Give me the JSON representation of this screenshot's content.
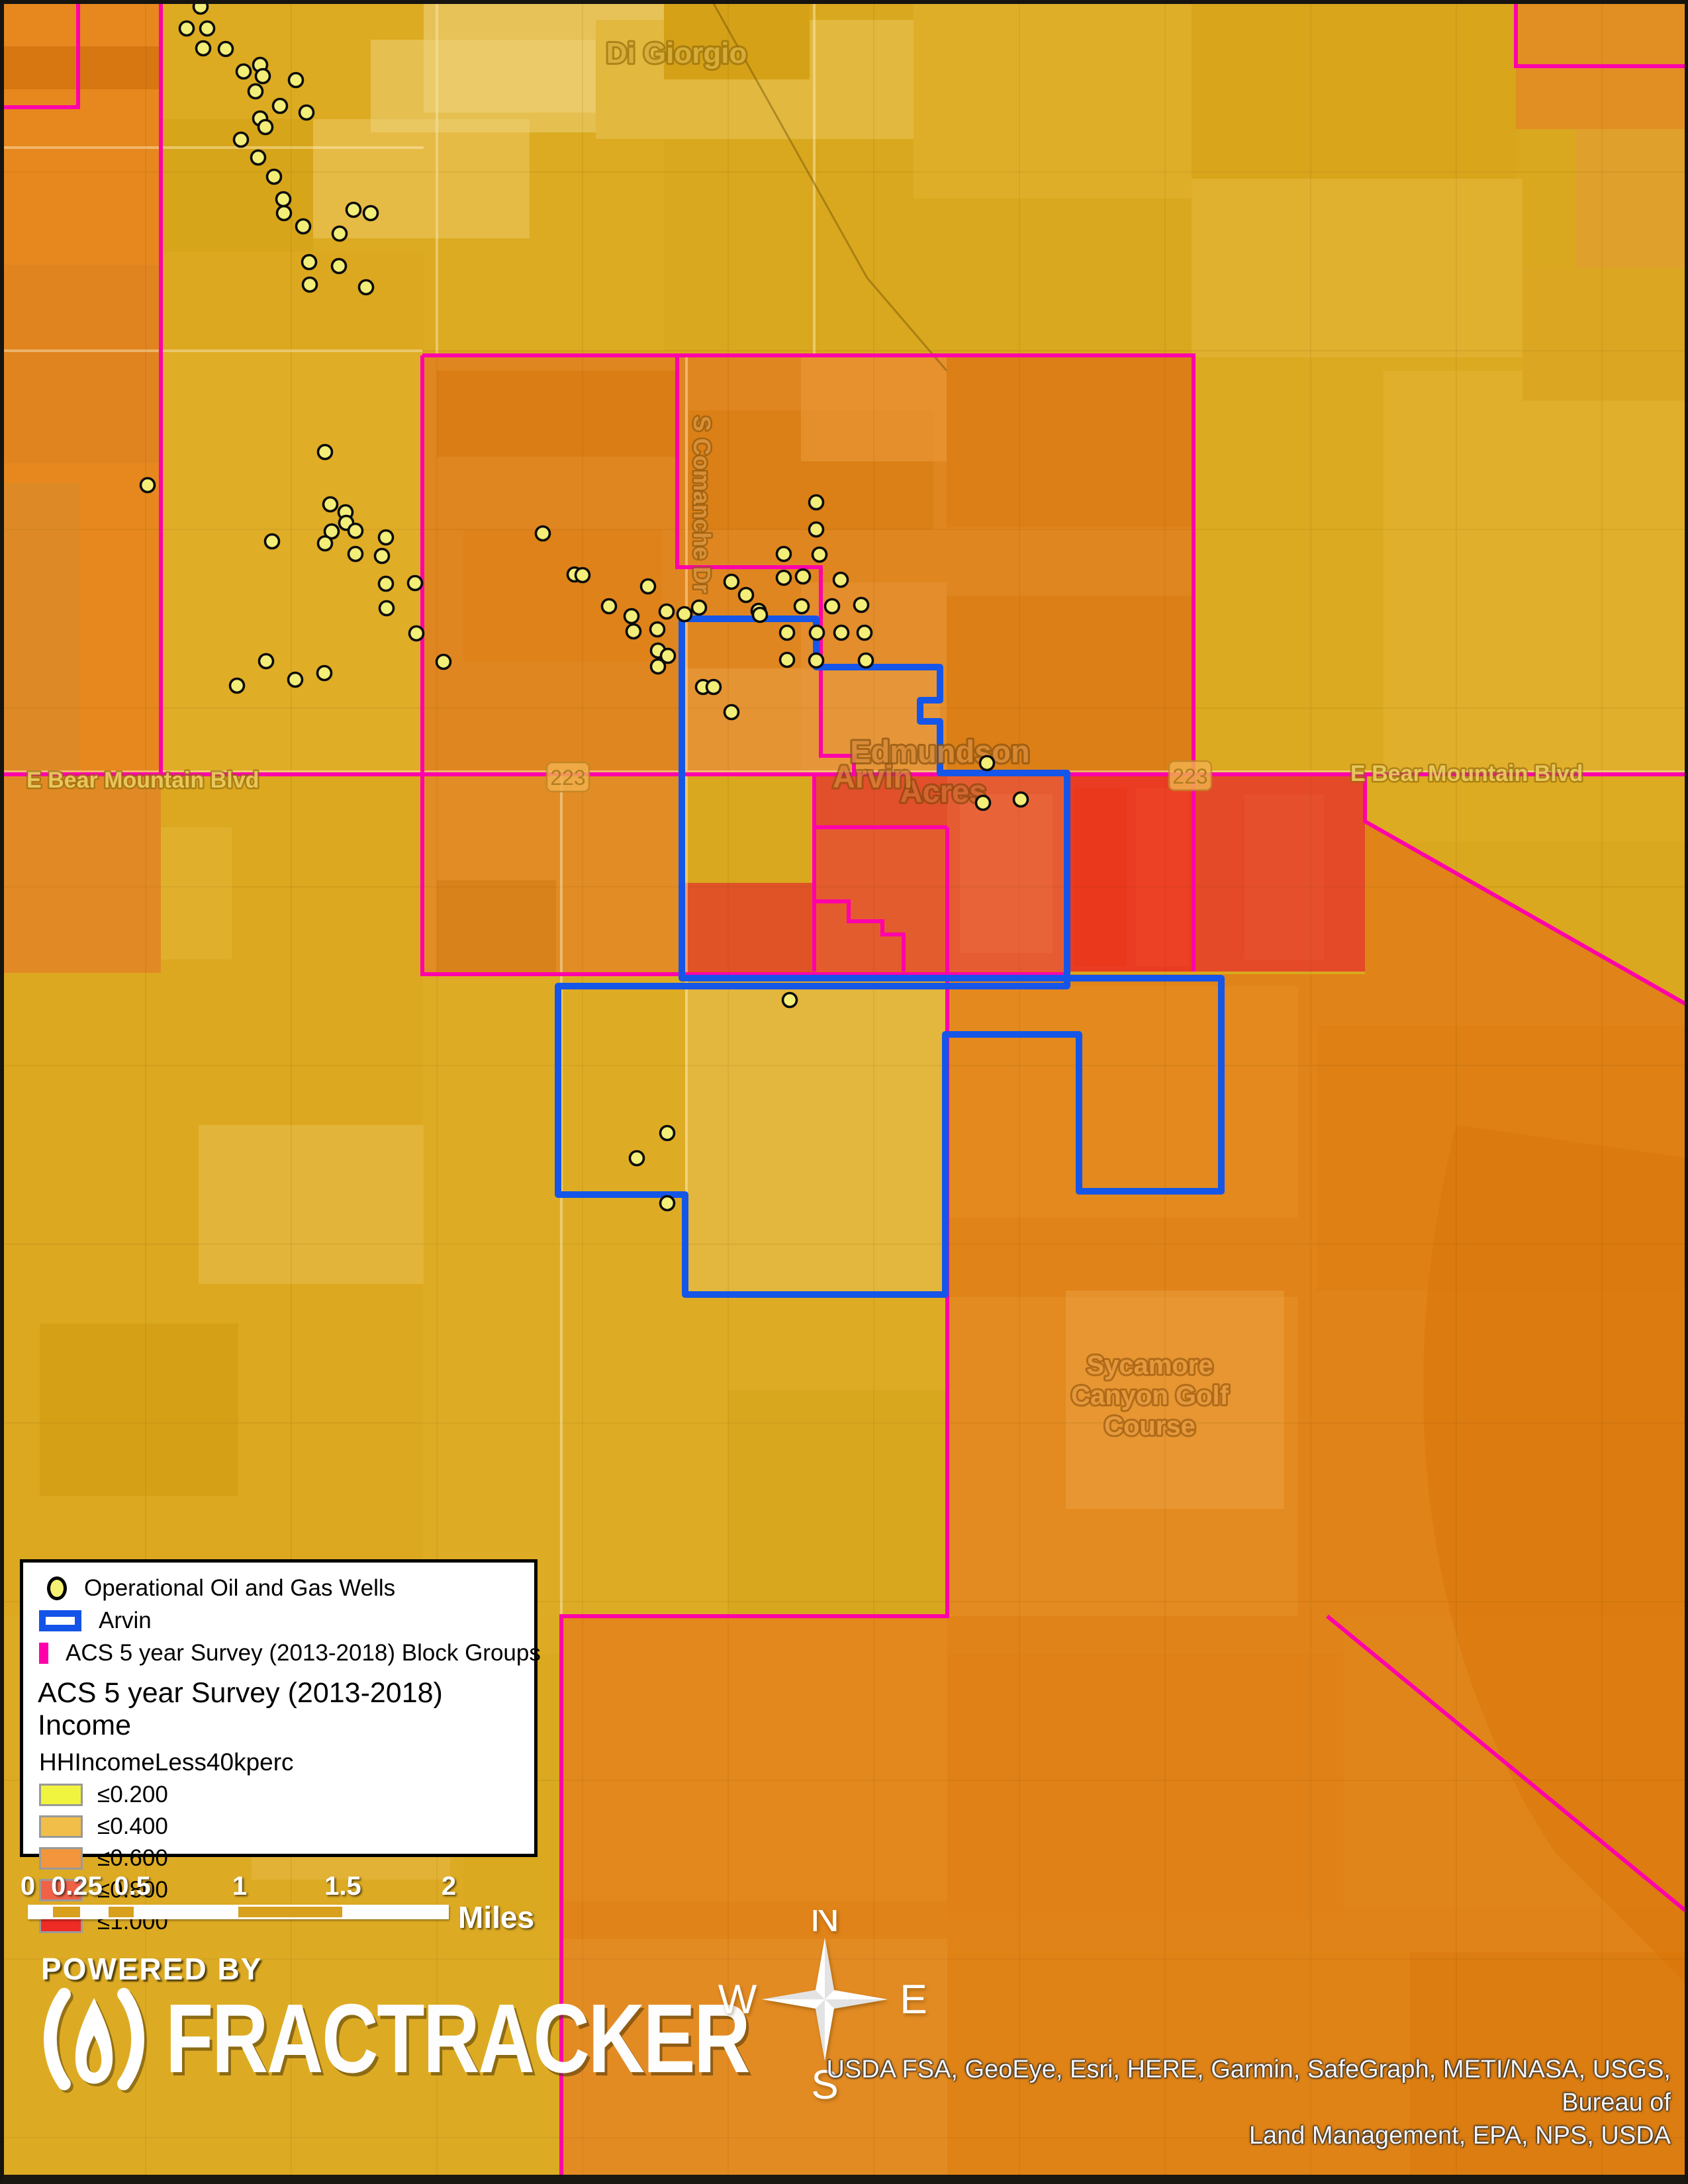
{
  "legend": {
    "wells_label": "Operational Oil and Gas Wells",
    "arvin_label": "Arvin",
    "block_groups_label": "ACS 5 year Survey (2013-2018) Block Groups",
    "income_header": "ACS 5 year Survey (2013-2018) Income",
    "field_name": "HHIncomeLess40kperc",
    "classes": [
      {
        "label": "≤0.200",
        "color": "#F1F43F"
      },
      {
        "label": "≤0.400",
        "color": "#F0BE49"
      },
      {
        "label": "≤0.600",
        "color": "#F2953C"
      },
      {
        "label": "≤0.800",
        "color": "#F06247"
      },
      {
        "label": "≤1.000",
        "color": "#EE2B25"
      }
    ]
  },
  "scale_bar": {
    "ticks": [
      "0",
      "0.25",
      "0.5",
      "1",
      "1.5",
      "2"
    ],
    "unit": "Miles"
  },
  "compass": {
    "north": "N",
    "south": "S",
    "east": "E",
    "west": "W"
  },
  "branding": {
    "powered_by": "POWERED BY",
    "brand": "FRACTRACKER"
  },
  "attribution": {
    "line1": "USDA FSA, GeoEye, Esri, HERE, Garmin, SafeGraph, METI/NASA, USGS, Bureau of",
    "line2": "Land Management, EPA, NPS, USDA"
  },
  "map_labels": {
    "di_giorgio": "Di Giorgio",
    "edmundson_line1": "Edmundson",
    "edmundson_line2": "Acres",
    "arvin_town": "Arvin",
    "bear_mountain_blvd": "E Bear Mountain Blvd",
    "comanche_dr": "S Comanche Dr",
    "route_223": "223",
    "golf_line1": "Sycamore",
    "golf_line2": "Canyon Golf",
    "golf_line3": "Course"
  },
  "colors": {
    "block_group_outline": "#FF00AA",
    "arvin_outline": "#1556E8",
    "well_fill": "#F3EE78"
  },
  "wells": [
    [
      303,
      10
    ],
    [
      282,
      43
    ],
    [
      313,
      43
    ],
    [
      307,
      73
    ],
    [
      341,
      74
    ],
    [
      393,
      98
    ],
    [
      368,
      108
    ],
    [
      397,
      115
    ],
    [
      447,
      121
    ],
    [
      386,
      138
    ],
    [
      423,
      160
    ],
    [
      463,
      170
    ],
    [
      393,
      179
    ],
    [
      401,
      192
    ],
    [
      364,
      211
    ],
    [
      390,
      238
    ],
    [
      414,
      267
    ],
    [
      428,
      301
    ],
    [
      429,
      322
    ],
    [
      458,
      342
    ],
    [
      534,
      317
    ],
    [
      560,
      322
    ],
    [
      513,
      353
    ],
    [
      467,
      396
    ],
    [
      512,
      402
    ],
    [
      468,
      430
    ],
    [
      553,
      434
    ],
    [
      223,
      733
    ],
    [
      491,
      683
    ],
    [
      499,
      762
    ],
    [
      522,
      774
    ],
    [
      523,
      790
    ],
    [
      501,
      803
    ],
    [
      537,
      802
    ],
    [
      491,
      821
    ],
    [
      411,
      818
    ],
    [
      537,
      837
    ],
    [
      583,
      812
    ],
    [
      577,
      840
    ],
    [
      583,
      882
    ],
    [
      627,
      881
    ],
    [
      584,
      919
    ],
    [
      629,
      957
    ],
    [
      402,
      999
    ],
    [
      446,
      1027
    ],
    [
      490,
      1017
    ],
    [
      358,
      1036
    ],
    [
      670,
      1000
    ],
    [
      820,
      806
    ],
    [
      868,
      868
    ],
    [
      880,
      869
    ],
    [
      979,
      886
    ],
    [
      920,
      916
    ],
    [
      954,
      931
    ],
    [
      1007,
      924
    ],
    [
      1034,
      928
    ],
    [
      1056,
      918
    ],
    [
      957,
      954
    ],
    [
      993,
      951
    ],
    [
      994,
      983
    ],
    [
      1009,
      991
    ],
    [
      994,
      1007
    ],
    [
      1062,
      1038
    ],
    [
      1078,
      1038
    ],
    [
      1105,
      1076
    ],
    [
      1105,
      879
    ],
    [
      1127,
      899
    ],
    [
      1146,
      923
    ],
    [
      1148,
      929
    ],
    [
      1184,
      837
    ],
    [
      1184,
      873
    ],
    [
      1213,
      871
    ],
    [
      1211,
      916
    ],
    [
      1233,
      759
    ],
    [
      1233,
      800
    ],
    [
      1238,
      838
    ],
    [
      1257,
      916
    ],
    [
      1270,
      876
    ],
    [
      1301,
      914
    ],
    [
      1189,
      956
    ],
    [
      1234,
      956
    ],
    [
      1271,
      956
    ],
    [
      1306,
      956
    ],
    [
      1189,
      997
    ],
    [
      1233,
      998
    ],
    [
      1308,
      998
    ],
    [
      1491,
      1153
    ],
    [
      1485,
      1213
    ],
    [
      1542,
      1208
    ],
    [
      1193,
      1511
    ],
    [
      1008,
      1712
    ],
    [
      962,
      1750
    ],
    [
      1008,
      1818
    ]
  ]
}
